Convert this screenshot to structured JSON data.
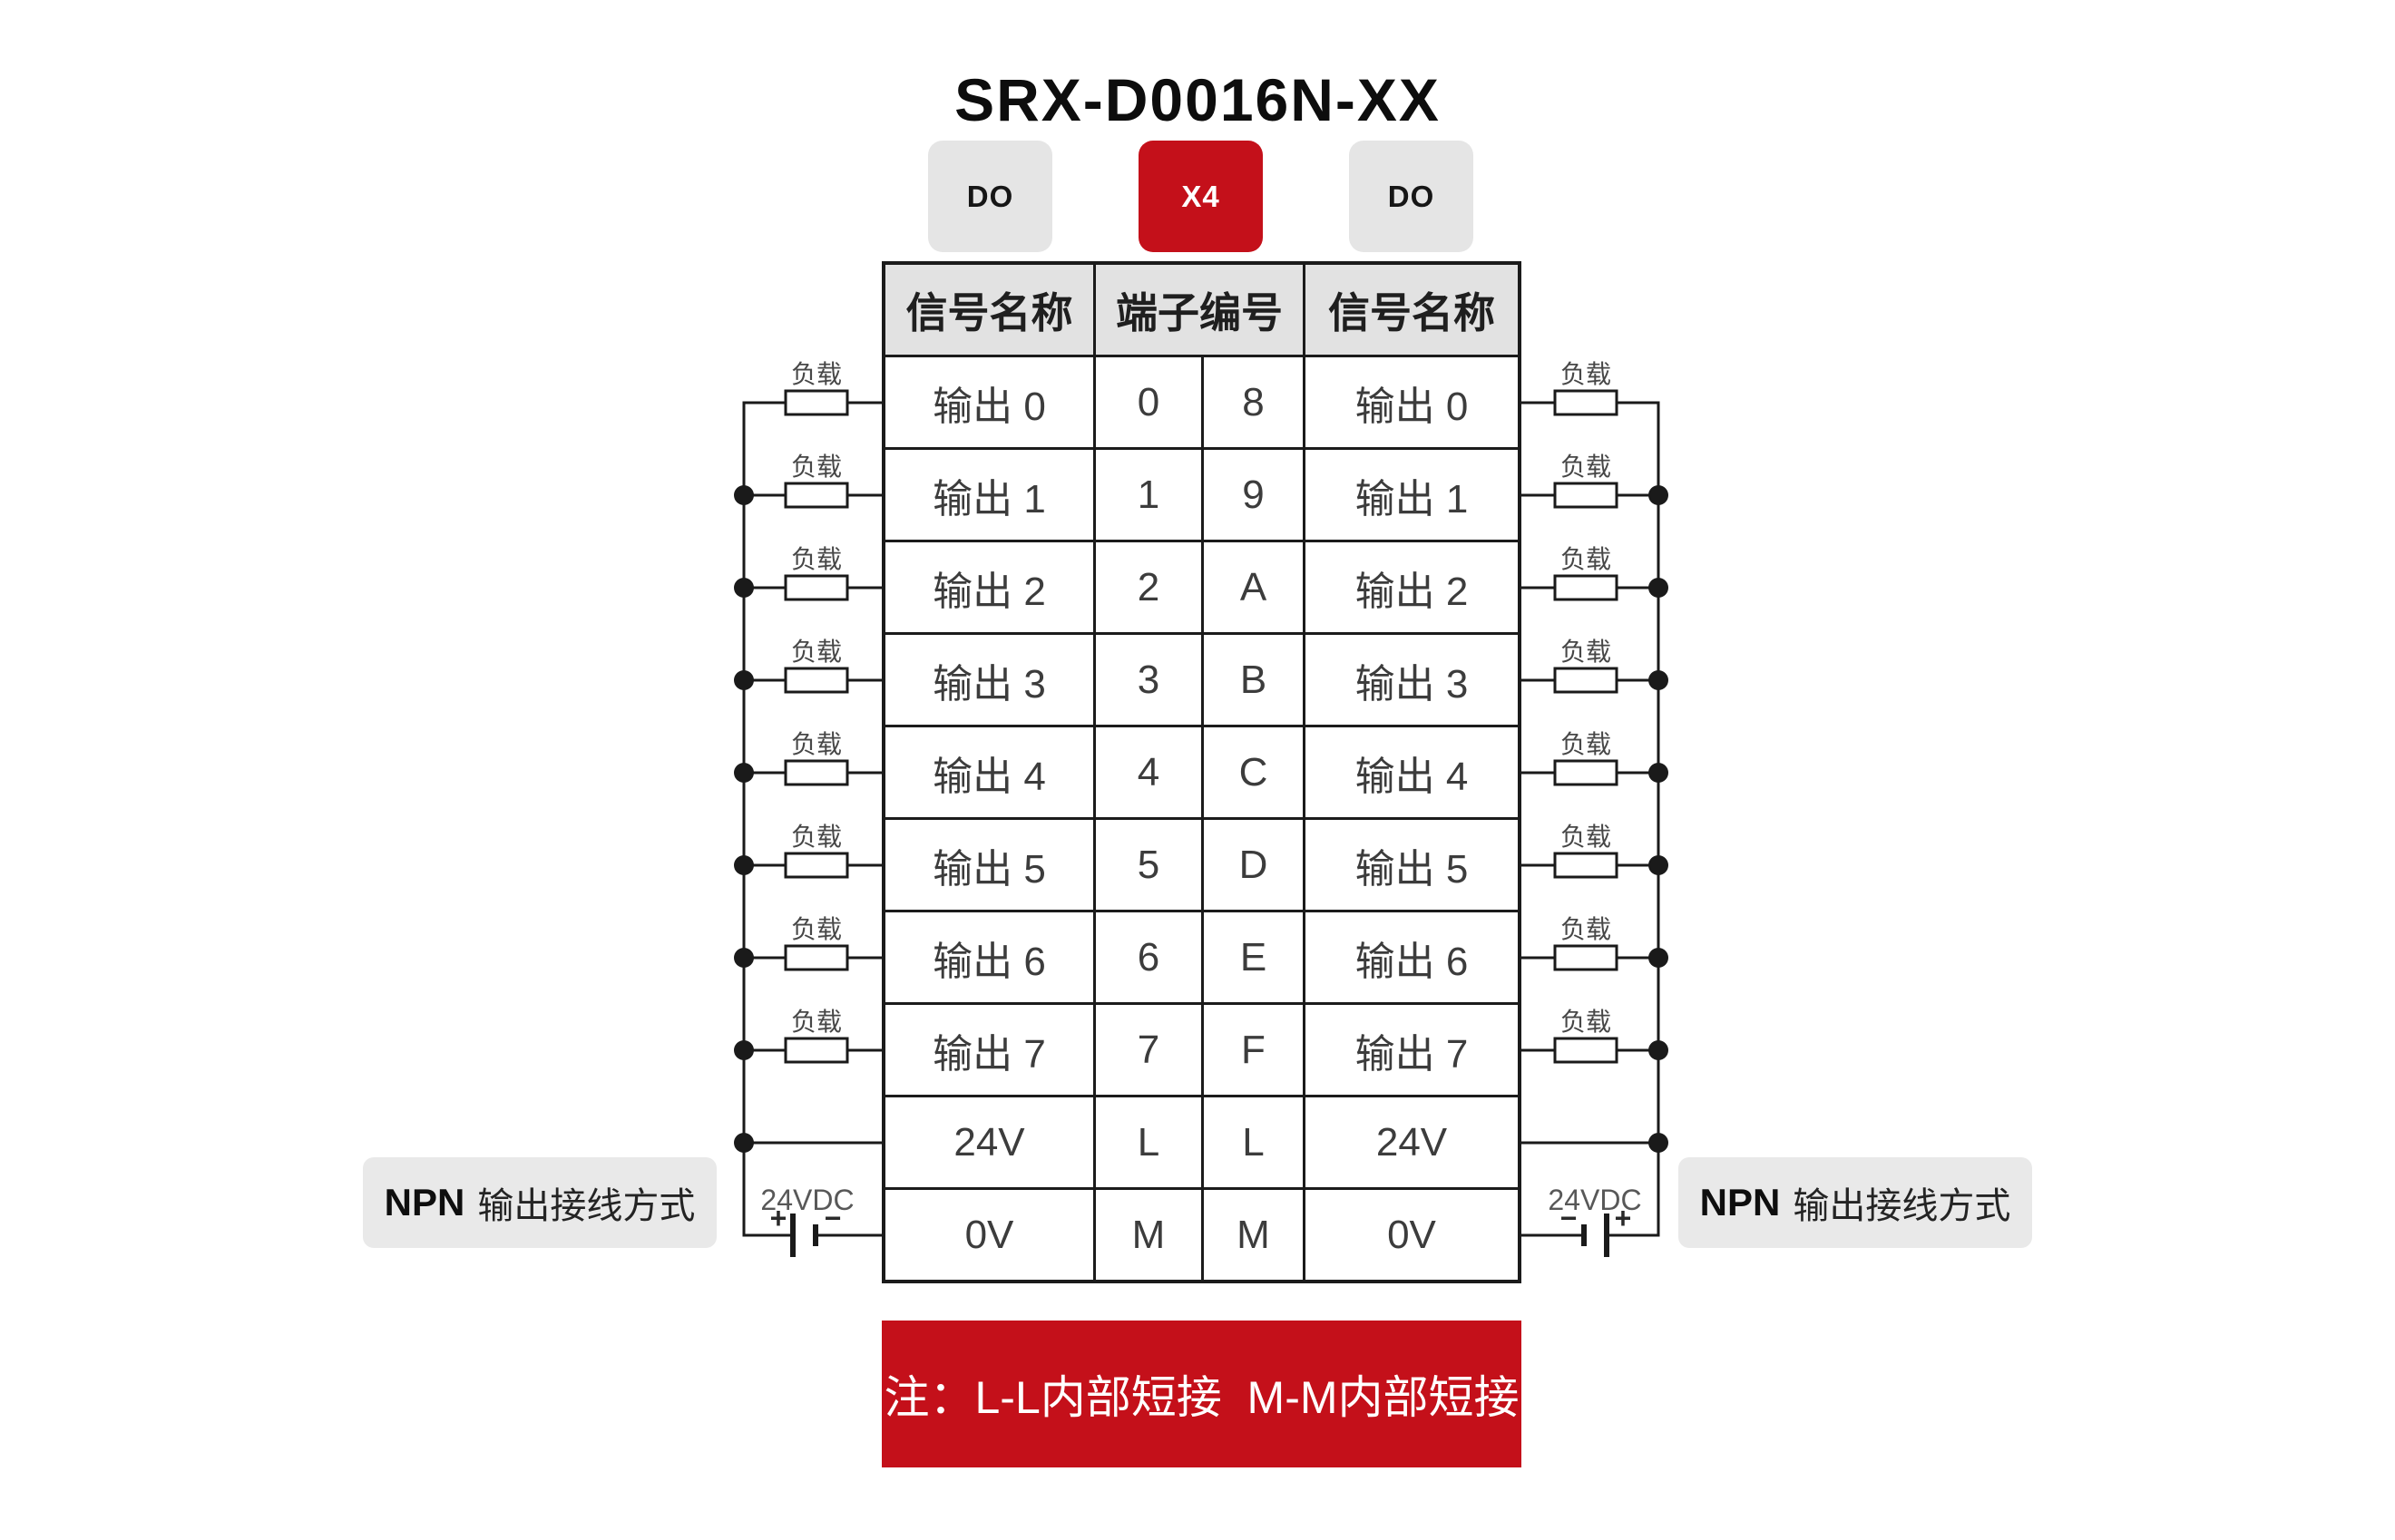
{
  "title": "SRX-D0016N-XX",
  "badges": {
    "left": "DO",
    "center": "X4",
    "right": "DO"
  },
  "colors": {
    "accent_red": "#c4101a",
    "badge_gray": "#e5e5e5",
    "header_gray": "#e2e2e2",
    "panel_gray": "#e9e9e9",
    "ink": "#1a1a1a"
  },
  "table": {
    "headers": {
      "left": "信号名称",
      "center": "端子编号",
      "right": "信号名称"
    },
    "rows": [
      {
        "left_signal": "输出 0",
        "terminal_left": "0",
        "terminal_right": "8",
        "right_signal": "输出 0"
      },
      {
        "left_signal": "输出 1",
        "terminal_left": "1",
        "terminal_right": "9",
        "right_signal": "输出 1"
      },
      {
        "left_signal": "输出 2",
        "terminal_left": "2",
        "terminal_right": "A",
        "right_signal": "输出 2"
      },
      {
        "left_signal": "输出 3",
        "terminal_left": "3",
        "terminal_right": "B",
        "right_signal": "输出 3"
      },
      {
        "left_signal": "输出 4",
        "terminal_left": "4",
        "terminal_right": "C",
        "right_signal": "输出 4"
      },
      {
        "left_signal": "输出 5",
        "terminal_left": "5",
        "terminal_right": "D",
        "right_signal": "输出 5"
      },
      {
        "left_signal": "输出 6",
        "terminal_left": "6",
        "terminal_right": "E",
        "right_signal": "输出 6"
      },
      {
        "left_signal": "输出 7",
        "terminal_left": "7",
        "terminal_right": "F",
        "right_signal": "输出 7"
      },
      {
        "left_signal": "24V",
        "terminal_left": "L",
        "terminal_right": "L",
        "right_signal": "24V"
      },
      {
        "left_signal": "0V",
        "terminal_left": "M",
        "terminal_right": "M",
        "right_signal": "0V"
      }
    ]
  },
  "circuit": {
    "load_label": "负载",
    "psu_label": "24VDC",
    "battery_plus": "+",
    "battery_minus": "−",
    "wiring_method": {
      "prefix": "NPN",
      "text": "输出接线方式"
    }
  },
  "note_banner": "注：L-L内部短接  M-M内部短接"
}
